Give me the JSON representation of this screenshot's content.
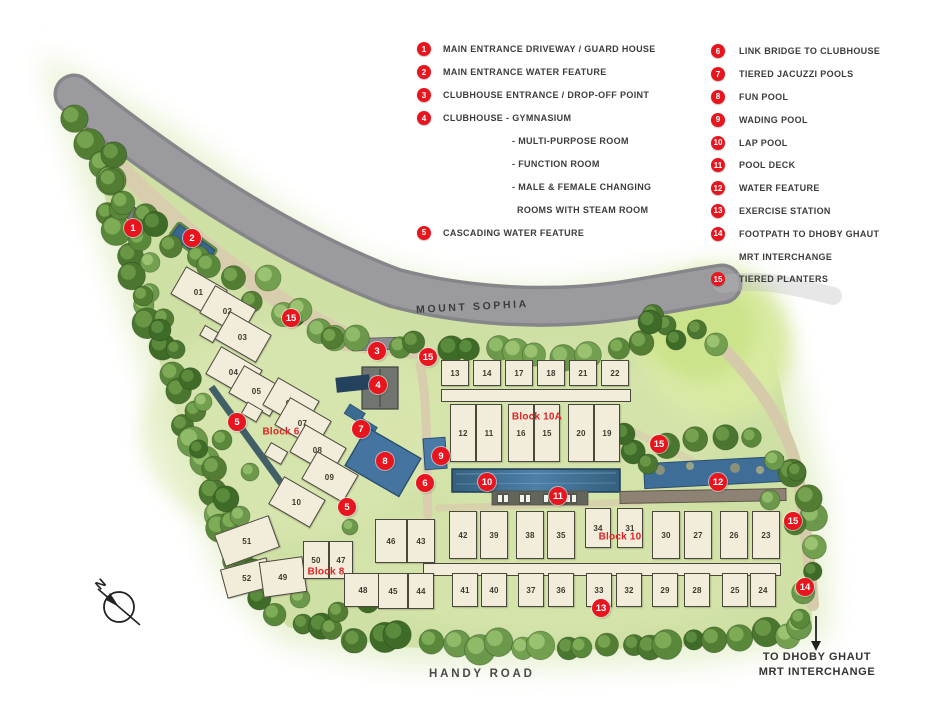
{
  "legend": {
    "left": [
      {
        "num": "1",
        "label": "MAIN ENTRANCE DRIVEWAY / GUARD HOUSE"
      },
      {
        "num": "2",
        "label": "MAIN ENTRANCE WATER FEATURE"
      },
      {
        "num": "3",
        "label": "CLUBHOUSE ENTRANCE / DROP-OFF POINT"
      },
      {
        "num": "4",
        "label": "CLUBHOUSE - GYMNASIUM",
        "sublines": [
          "- MULTI-PURPOSE ROOM",
          "- FUNCTION ROOM",
          "- MALE & FEMALE CHANGING",
          "ROOMS WITH STEAM ROOM"
        ]
      },
      {
        "num": "5",
        "label": "CASCADING WATER FEATURE"
      }
    ],
    "right": [
      {
        "num": "6",
        "label": "LINK BRIDGE TO CLUBHOUSE"
      },
      {
        "num": "7",
        "label": "TIERED JACUZZI POOLS"
      },
      {
        "num": "8",
        "label": "FUN POOL"
      },
      {
        "num": "9",
        "label": "WADING POOL"
      },
      {
        "num": "10",
        "label": "LAP POOL"
      },
      {
        "num": "11",
        "label": "POOL DECK"
      },
      {
        "num": "12",
        "label": "WATER FEATURE"
      },
      {
        "num": "13",
        "label": "EXERCISE STATION"
      },
      {
        "num": "14",
        "label": "FOOTPATH TO DHOBY GHAUT",
        "sublines": [
          "MRT INTERCHANGE"
        ]
      },
      {
        "num": "15",
        "label": "TIERED PLANTERS"
      }
    ]
  },
  "map": {
    "street_label": "MOUNT SOPHIA",
    "bottom_street_label": "HANDY ROAD",
    "exit_label_line1": "TO DHOBY GHAUT",
    "exit_label_line2": "MRT INTERCHANGE",
    "compass_label": "N",
    "block_labels": [
      {
        "name": "Block 6",
        "x": 281,
        "y": 432
      },
      {
        "name": "Block 8",
        "x": 326,
        "y": 572
      },
      {
        "name": "Block 10A",
        "x": 537,
        "y": 417
      },
      {
        "name": "Block 10",
        "x": 620,
        "y": 537
      }
    ],
    "units": [
      {
        "no": "01",
        "x": 199,
        "y": 292,
        "w": 48,
        "h": 32,
        "r": 30
      },
      {
        "no": "02",
        "x": 228,
        "y": 311,
        "w": 48,
        "h": 32,
        "r": 30
      },
      {
        "no": "03",
        "x": 243,
        "y": 337,
        "w": 48,
        "h": 32,
        "r": 30
      },
      {
        "no": "04",
        "x": 234,
        "y": 372,
        "w": 48,
        "h": 32,
        "r": 30
      },
      {
        "no": "05",
        "x": 257,
        "y": 391,
        "w": 48,
        "h": 32,
        "r": 30
      },
      {
        "no": "06",
        "x": 291,
        "y": 403,
        "w": 48,
        "h": 32,
        "r": 30
      },
      {
        "no": "07",
        "x": 303,
        "y": 423,
        "w": 48,
        "h": 32,
        "r": 30
      },
      {
        "no": "08",
        "x": 318,
        "y": 450,
        "w": 48,
        "h": 32,
        "r": 30
      },
      {
        "no": "09",
        "x": 330,
        "y": 477,
        "w": 48,
        "h": 32,
        "r": 30
      },
      {
        "no": "10",
        "x": 297,
        "y": 502,
        "w": 48,
        "h": 32,
        "r": 30
      },
      {
        "no": "",
        "x": 209,
        "y": 334,
        "w": 16,
        "h": 12,
        "r": 30
      },
      {
        "no": "",
        "x": 252,
        "y": 412,
        "w": 18,
        "h": 14,
        "r": 30
      },
      {
        "no": "",
        "x": 276,
        "y": 453,
        "w": 20,
        "h": 15,
        "r": 30
      },
      {
        "no": "51",
        "x": 247,
        "y": 541,
        "w": 58,
        "h": 34,
        "r": -20
      },
      {
        "no": "52",
        "x": 247,
        "y": 578,
        "w": 48,
        "h": 30,
        "r": -15
      },
      {
        "no": "49",
        "x": 283,
        "y": 577,
        "w": 44,
        "h": 36,
        "r": -8
      },
      {
        "no": "50",
        "x": 316,
        "y": 560,
        "w": 26,
        "h": 38,
        "r": 0
      },
      {
        "no": "47",
        "x": 341,
        "y": 560,
        "w": 24,
        "h": 38,
        "r": 0
      },
      {
        "no": "48",
        "x": 363,
        "y": 590,
        "w": 38,
        "h": 34,
        "r": 0
      },
      {
        "no": "46",
        "x": 391,
        "y": 541,
        "w": 32,
        "h": 44,
        "r": 0
      },
      {
        "no": "43",
        "x": 421,
        "y": 541,
        "w": 28,
        "h": 44,
        "r": 0
      },
      {
        "no": "45",
        "x": 393,
        "y": 591,
        "w": 30,
        "h": 36,
        "r": 0
      },
      {
        "no": "44",
        "x": 421,
        "y": 591,
        "w": 26,
        "h": 36,
        "r": 0
      },
      {
        "no": "13",
        "x": 455,
        "y": 373,
        "w": 28,
        "h": 26,
        "r": 0
      },
      {
        "no": "14",
        "x": 487,
        "y": 373,
        "w": 28,
        "h": 26,
        "r": 0
      },
      {
        "no": "17",
        "x": 519,
        "y": 373,
        "w": 28,
        "h": 26,
        "r": 0
      },
      {
        "no": "18",
        "x": 551,
        "y": 373,
        "w": 28,
        "h": 26,
        "r": 0
      },
      {
        "no": "21",
        "x": 583,
        "y": 373,
        "w": 28,
        "h": 26,
        "r": 0
      },
      {
        "no": "22",
        "x": 615,
        "y": 373,
        "w": 28,
        "h": 26,
        "r": 0
      },
      {
        "no": "12",
        "x": 463,
        "y": 433,
        "w": 26,
        "h": 58,
        "r": 0
      },
      {
        "no": "11",
        "x": 489,
        "y": 433,
        "w": 26,
        "h": 58,
        "r": 0
      },
      {
        "no": "16",
        "x": 521,
        "y": 433,
        "w": 26,
        "h": 58,
        "r": 0
      },
      {
        "no": "15",
        "x": 547,
        "y": 433,
        "w": 26,
        "h": 58,
        "r": 0
      },
      {
        "no": "20",
        "x": 581,
        "y": 433,
        "w": 26,
        "h": 58,
        "r": 0
      },
      {
        "no": "19",
        "x": 607,
        "y": 433,
        "w": 26,
        "h": 58,
        "r": 0
      },
      {
        "no": "42",
        "x": 463,
        "y": 535,
        "w": 28,
        "h": 48,
        "r": 0
      },
      {
        "no": "39",
        "x": 494,
        "y": 535,
        "w": 28,
        "h": 48,
        "r": 0
      },
      {
        "no": "38",
        "x": 530,
        "y": 535,
        "w": 28,
        "h": 48,
        "r": 0
      },
      {
        "no": "35",
        "x": 561,
        "y": 535,
        "w": 28,
        "h": 48,
        "r": 0
      },
      {
        "no": "34",
        "x": 598,
        "y": 528,
        "w": 26,
        "h": 40,
        "r": 0
      },
      {
        "no": "31",
        "x": 630,
        "y": 528,
        "w": 26,
        "h": 40,
        "r": 0
      },
      {
        "no": "30",
        "x": 666,
        "y": 535,
        "w": 28,
        "h": 48,
        "r": 0
      },
      {
        "no": "27",
        "x": 698,
        "y": 535,
        "w": 28,
        "h": 48,
        "r": 0
      },
      {
        "no": "26",
        "x": 734,
        "y": 535,
        "w": 28,
        "h": 48,
        "r": 0
      },
      {
        "no": "23",
        "x": 766,
        "y": 535,
        "w": 28,
        "h": 48,
        "r": 0
      },
      {
        "no": "41",
        "x": 465,
        "y": 590,
        "w": 26,
        "h": 34,
        "r": 0
      },
      {
        "no": "40",
        "x": 494,
        "y": 590,
        "w": 26,
        "h": 34,
        "r": 0
      },
      {
        "no": "37",
        "x": 531,
        "y": 590,
        "w": 26,
        "h": 34,
        "r": 0
      },
      {
        "no": "36",
        "x": 561,
        "y": 590,
        "w": 26,
        "h": 34,
        "r": 0
      },
      {
        "no": "33",
        "x": 599,
        "y": 590,
        "w": 26,
        "h": 34,
        "r": 0
      },
      {
        "no": "32",
        "x": 629,
        "y": 590,
        "w": 26,
        "h": 34,
        "r": 0
      },
      {
        "no": "29",
        "x": 665,
        "y": 590,
        "w": 26,
        "h": 34,
        "r": 0
      },
      {
        "no": "28",
        "x": 697,
        "y": 590,
        "w": 26,
        "h": 34,
        "r": 0
      },
      {
        "no": "25",
        "x": 735,
        "y": 590,
        "w": 26,
        "h": 34,
        "r": 0
      },
      {
        "no": "24",
        "x": 763,
        "y": 590,
        "w": 26,
        "h": 34,
        "r": 0
      }
    ],
    "markers": [
      {
        "num": "1",
        "x": 133,
        "y": 228
      },
      {
        "num": "2",
        "x": 192,
        "y": 238
      },
      {
        "num": "15",
        "x": 291,
        "y": 318
      },
      {
        "num": "3",
        "x": 377,
        "y": 351
      },
      {
        "num": "15",
        "x": 428,
        "y": 357
      },
      {
        "num": "4",
        "x": 378,
        "y": 385
      },
      {
        "num": "5",
        "x": 237,
        "y": 422
      },
      {
        "num": "7",
        "x": 361,
        "y": 429
      },
      {
        "num": "8",
        "x": 385,
        "y": 461
      },
      {
        "num": "9",
        "x": 441,
        "y": 456
      },
      {
        "num": "6",
        "x": 425,
        "y": 483
      },
      {
        "num": "10",
        "x": 487,
        "y": 482
      },
      {
        "num": "11",
        "x": 558,
        "y": 496
      },
      {
        "num": "5",
        "x": 347,
        "y": 507
      },
      {
        "num": "15",
        "x": 659,
        "y": 444
      },
      {
        "num": "12",
        "x": 718,
        "y": 482
      },
      {
        "num": "15",
        "x": 793,
        "y": 521
      },
      {
        "num": "13",
        "x": 601,
        "y": 608
      },
      {
        "num": "14",
        "x": 805,
        "y": 587
      }
    ]
  },
  "colors": {
    "marker_red": "#e8151e",
    "block_label_red": "#e02424",
    "building_fill": "#f2ecda",
    "road_grey": "#9b9b9f",
    "pool_blue": "#3e6b92",
    "site_green": "#d2e2a6"
  }
}
